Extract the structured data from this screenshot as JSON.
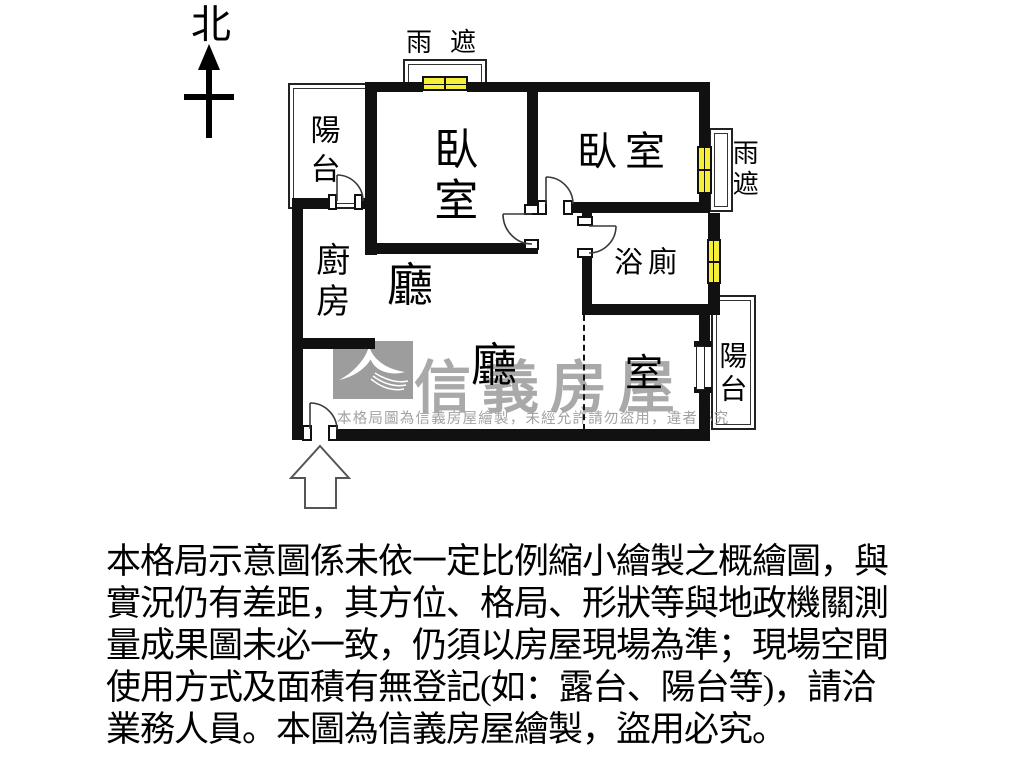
{
  "north": {
    "label": "北"
  },
  "plan": {
    "balcony_top": "陽台",
    "bedroom_left": "臥室",
    "bedroom_right": "臥室",
    "kitchen": "廚房",
    "hall_upper": "廳",
    "hall_lower": "廳",
    "den": "室",
    "bathroom": "浴廁",
    "balcony_right": "陽台",
    "rain_shelter_top": "雨遮",
    "rain_shelter_right": "雨遮"
  },
  "watermark": {
    "brand": "信義房屋",
    "notice": "本格局圖為信義房屋繪製，未經允許請勿盜用，違者必究"
  },
  "disclaimer": {
    "line1": "本格局示意圖係未依一定比例縮小繪製之概繪圖，與",
    "line2": "實況仍有差距，其方位、格局、形狀等與地政機關測",
    "line3": "量成果圖未必一致，仍須以房屋現場為準；現場空間",
    "line4": "使用方式及面積有無登記(如：露台、陽台等)，請洽",
    "line5": "業務人員。本圖為信義房屋繪製，盜用必究。"
  },
  "colors": {
    "wall": "#111111",
    "window_fill": "#f7ee38",
    "watermark_gray": "#a9a9a9"
  }
}
